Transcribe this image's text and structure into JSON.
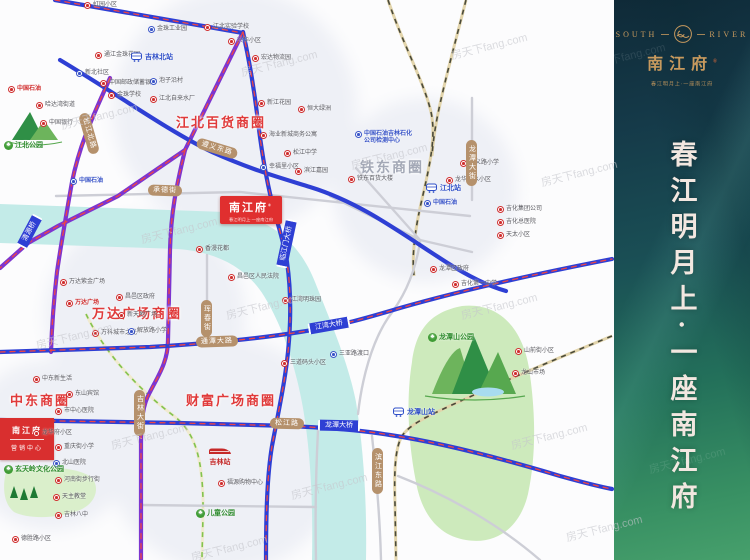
{
  "panel": {
    "brand_en_left": "SOUTH",
    "brand_en_right": "RIVER",
    "brand_cn": "南江府",
    "brand_reg": "®",
    "tagline": "春江明月上·一座南江府",
    "slogan": "春江明月上·一座南江府"
  },
  "project": {
    "name": "南江府",
    "reg": "®",
    "subtitle": "春江明月上·一座南江府"
  },
  "sales_box": {
    "line1": "南江府",
    "line2": "营销中心"
  },
  "watermark_text": "房天下fang.com",
  "colors": {
    "road_blue": "#2e3fd4",
    "road_purple": "#7d35cf",
    "metro_dash": "#ef4444",
    "capsule_tan": "#b5916c",
    "project_red": "#e02f2f",
    "park_green": "#cdeabc",
    "river_cyan": "#c3ebe8",
    "brand_gold": "#c89a5e"
  },
  "districts": [
    {
      "t": "江北百货商圈",
      "x": 176,
      "y": 112,
      "c": "red"
    },
    {
      "t": "铁东商圈",
      "x": 360,
      "y": 157,
      "c": "gray"
    },
    {
      "t": "万达广场商圈",
      "x": 92,
      "y": 303,
      "c": "red"
    },
    {
      "t": "财富广场商圈",
      "x": 186,
      "y": 390,
      "c": "red"
    },
    {
      "t": "中东商圈",
      "x": 10,
      "y": 390,
      "c": "red"
    }
  ],
  "stations": [
    {
      "t": "吉林北站",
      "x": 130,
      "y": 52,
      "type": "blue"
    },
    {
      "t": "江北站",
      "x": 425,
      "y": 183,
      "type": "blue"
    },
    {
      "t": "龙潭山站",
      "x": 392,
      "y": 407,
      "type": "blue"
    },
    {
      "t": "吉林站",
      "x": 208,
      "y": 446,
      "type": "red"
    }
  ],
  "parks": [
    {
      "t": "江北公园",
      "x": 4,
      "y": 140
    },
    {
      "t": "龙潭山公园",
      "x": 428,
      "y": 332
    },
    {
      "t": "儿童公园",
      "x": 196,
      "y": 508
    },
    {
      "t": "玄天岭文化公园",
      "x": 4,
      "y": 464
    }
  ],
  "road_labels": [
    {
      "t": "遵义东路",
      "x": 196,
      "y": 143,
      "rot": 17
    },
    {
      "t": "通潭大路",
      "x": 196,
      "y": 336,
      "rot": -2
    },
    {
      "t": "承德街",
      "x": 148,
      "y": 185,
      "rot": 2
    },
    {
      "t": "松江路",
      "x": 270,
      "y": 418,
      "rot": 1
    },
    {
      "t": "吉林大街",
      "x": 134,
      "y": 390,
      "vert": 1
    },
    {
      "t": "松江北路",
      "x": 68,
      "y": 128,
      "rot": 74
    },
    {
      "t": "珲春街",
      "x": 201,
      "y": 300,
      "vert": 1
    },
    {
      "t": "龙潭大街",
      "x": 466,
      "y": 140,
      "vert": 1
    },
    {
      "t": "滨江东路",
      "x": 372,
      "y": 448,
      "vert": 1
    },
    {
      "t": "清源桥",
      "x": 12,
      "y": 226,
      "rot": -62,
      "bridge": 1
    },
    {
      "t": "临江门大桥",
      "x": 262,
      "y": 238,
      "rot": -78,
      "bridge": 1
    },
    {
      "t": "江湾大桥",
      "x": 308,
      "y": 320,
      "rot": -10,
      "bridge": 1
    },
    {
      "t": "龙潭大桥",
      "x": 318,
      "y": 420,
      "rot": 1,
      "bridge": 1
    }
  ],
  "pois": [
    {
      "x": 84,
      "y": 2,
      "c": "r",
      "t": "虹园小区"
    },
    {
      "x": 8,
      "y": 86,
      "c": "r",
      "t": "中国石油",
      "tc": "red"
    },
    {
      "x": 36,
      "y": 102,
      "c": "r",
      "t": "哈达湾街道"
    },
    {
      "x": 40,
      "y": 120,
      "c": "r",
      "t": "中国银行"
    },
    {
      "x": 95,
      "y": 52,
      "c": "r",
      "t": "通江金珠花园"
    },
    {
      "x": 76,
      "y": 70,
      "c": "b",
      "t": "新北社区"
    },
    {
      "x": 100,
      "y": 80,
      "c": "r",
      "t": "中国邮政储蓄银行"
    },
    {
      "x": 108,
      "y": 92,
      "c": "r",
      "t": "金珠学校"
    },
    {
      "x": 148,
      "y": 26,
      "c": "b",
      "t": "金珠工业园"
    },
    {
      "x": 204,
      "y": 24,
      "c": "r",
      "t": "江北实验学校"
    },
    {
      "x": 228,
      "y": 38,
      "c": "r",
      "t": "兴华小区"
    },
    {
      "x": 150,
      "y": 78,
      "c": "b",
      "t": "泡子沿村"
    },
    {
      "x": 150,
      "y": 96,
      "c": "r",
      "t": "江北自来水厂"
    },
    {
      "x": 252,
      "y": 55,
      "c": "r",
      "t": "宏达物流园"
    },
    {
      "x": 258,
      "y": 100,
      "c": "r",
      "t": "新江花园"
    },
    {
      "x": 260,
      "y": 132,
      "c": "r",
      "t": "海业新城商务公寓"
    },
    {
      "x": 298,
      "y": 106,
      "c": "r",
      "t": "恒大绿洲"
    },
    {
      "x": 284,
      "y": 150,
      "c": "r",
      "t": "松江中学"
    },
    {
      "x": 295,
      "y": 168,
      "c": "r",
      "t": "滨江嘉园"
    },
    {
      "x": 260,
      "y": 164,
      "c": "b",
      "t": "幸福里小区"
    },
    {
      "x": 355,
      "y": 131,
      "c": "b",
      "t": "中国石油吉林石化\n公司检测中心",
      "tc": "blue"
    },
    {
      "x": 348,
      "y": 176,
      "c": "r",
      "t": "铁东百货大楼"
    },
    {
      "x": 460,
      "y": 160,
      "c": "r",
      "t": "遵义路小学"
    },
    {
      "x": 446,
      "y": 177,
      "c": "r",
      "t": "龙华山水小区"
    },
    {
      "x": 497,
      "y": 206,
      "c": "r",
      "t": "吉化集团公司"
    },
    {
      "x": 497,
      "y": 219,
      "c": "r",
      "t": "吉化总医院"
    },
    {
      "x": 497,
      "y": 232,
      "c": "r",
      "t": "天太小区"
    },
    {
      "x": 430,
      "y": 266,
      "c": "r",
      "t": "龙潭区政府"
    },
    {
      "x": 452,
      "y": 281,
      "c": "r",
      "t": "吉化第一中学"
    },
    {
      "x": 424,
      "y": 200,
      "c": "b",
      "t": "中国石油",
      "tc": "blue"
    },
    {
      "x": 70,
      "y": 178,
      "c": "b",
      "t": "中国石油",
      "tc": "blue"
    },
    {
      "x": 228,
      "y": 274,
      "c": "r",
      "t": "昌邑区人民法院"
    },
    {
      "x": 282,
      "y": 297,
      "c": "r",
      "t": "江湾明珠园"
    },
    {
      "x": 281,
      "y": 360,
      "c": "r",
      "t": "三道码头小区"
    },
    {
      "x": 330,
      "y": 351,
      "c": "b",
      "t": "三亚路渡口"
    },
    {
      "x": 196,
      "y": 246,
      "c": "r",
      "t": "香漫花都"
    },
    {
      "x": 60,
      "y": 279,
      "c": "r",
      "t": "万达紫金广场"
    },
    {
      "x": 66,
      "y": 300,
      "c": "r",
      "t": "万达广场",
      "tc": "red"
    },
    {
      "x": 116,
      "y": 294,
      "c": "r",
      "t": "昌邑区政府"
    },
    {
      "x": 118,
      "y": 312,
      "c": "r",
      "t": "新天地广场"
    },
    {
      "x": 92,
      "y": 330,
      "c": "r",
      "t": "万科城市之光"
    },
    {
      "x": 128,
      "y": 328,
      "c": "b",
      "t": "解放路小学"
    },
    {
      "x": 33,
      "y": 376,
      "c": "r",
      "t": "中东新生活"
    },
    {
      "x": 66,
      "y": 391,
      "c": "r",
      "t": "东山宾馆"
    },
    {
      "x": 55,
      "y": 408,
      "c": "r",
      "t": "市中心医院"
    },
    {
      "x": 33,
      "y": 430,
      "c": "r",
      "t": "龙华府小区"
    },
    {
      "x": 55,
      "y": 444,
      "c": "r",
      "t": "重庆街小学"
    },
    {
      "x": 53,
      "y": 460,
      "c": "b",
      "t": "北山医院"
    },
    {
      "x": 55,
      "y": 477,
      "c": "r",
      "t": "河南街步行街"
    },
    {
      "x": 53,
      "y": 494,
      "c": "r",
      "t": "天主教堂"
    },
    {
      "x": 55,
      "y": 512,
      "c": "r",
      "t": "吉林八中"
    },
    {
      "x": 12,
      "y": 536,
      "c": "r",
      "t": "德胜路小区"
    },
    {
      "x": 218,
      "y": 480,
      "c": "r",
      "t": "福源购物中心"
    },
    {
      "x": 515,
      "y": 348,
      "c": "r",
      "t": "山前街小区"
    },
    {
      "x": 512,
      "y": 370,
      "c": "r",
      "t": "龙山市场"
    }
  ],
  "watermarks": [
    {
      "x": 60,
      "y": 108
    },
    {
      "x": 240,
      "y": 55
    },
    {
      "x": 450,
      "y": 38
    },
    {
      "x": 140,
      "y": 222
    },
    {
      "x": 350,
      "y": 148
    },
    {
      "x": 540,
      "y": 165
    },
    {
      "x": 35,
      "y": 328
    },
    {
      "x": 225,
      "y": 298
    },
    {
      "x": 460,
      "y": 298
    },
    {
      "x": 110,
      "y": 428
    },
    {
      "x": 290,
      "y": 478
    },
    {
      "x": 510,
      "y": 428
    },
    {
      "x": 190,
      "y": 540
    },
    {
      "x": 565,
      "y": 520
    },
    {
      "x": 588,
      "y": 48,
      "light": 1
    },
    {
      "x": 648,
      "y": 452,
      "light": 1
    }
  ]
}
